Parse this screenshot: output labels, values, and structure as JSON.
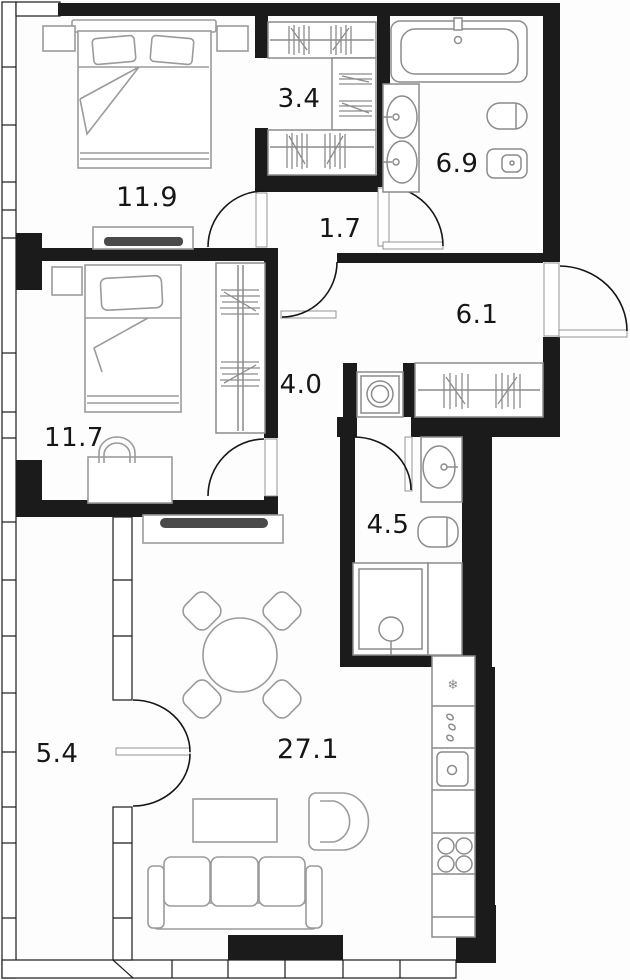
{
  "title": "Apartment floor plan",
  "units": "m2",
  "colors": {
    "wall": "#1b1b1b",
    "furniture_stroke": "#9b9b9b",
    "fixture_stroke": "#8c8c8c",
    "door_stroke": "#161616",
    "label_text": "#161616",
    "tv_fill": "#4a4a4a",
    "background": "#fdfdfd"
  },
  "icons": {
    "fridge_snowflake": "❄"
  },
  "rooms": [
    {
      "id": "bedroom-1",
      "type": "bedroom",
      "area": "11.9"
    },
    {
      "id": "walk-in-closet",
      "type": "wardrobe",
      "area": "3.4"
    },
    {
      "id": "bathroom-main",
      "type": "bathroom",
      "area": "6.9"
    },
    {
      "id": "vestibule",
      "type": "hallway",
      "area": "1.7"
    },
    {
      "id": "entry-hall",
      "type": "hallway",
      "area": "6.1"
    },
    {
      "id": "bedroom-2",
      "type": "bedroom",
      "area": "11.7"
    },
    {
      "id": "corridor",
      "type": "corridor",
      "area": "4.0"
    },
    {
      "id": "bathroom-small",
      "type": "bathroom",
      "area": "4.5"
    },
    {
      "id": "balcony",
      "type": "balcony",
      "area": "5.4"
    },
    {
      "id": "living-kitchen",
      "type": "living-room",
      "area": "27.1"
    }
  ],
  "furniture": [
    "double-bed",
    "nightstands",
    "tv-console",
    "hanger-rails",
    "shelf-stacks",
    "bathtub",
    "double-washbasin",
    "toilet",
    "bidet",
    "entrance-door",
    "single-bed",
    "desk",
    "desk-chair",
    "wardrobe",
    "washing-machine",
    "coat-rack",
    "washbasin",
    "shower",
    "round-dining-table",
    "dining-chairs",
    "coffee-table",
    "armchair",
    "sofa",
    "fridge",
    "kitchen-sink",
    "cooktop"
  ]
}
